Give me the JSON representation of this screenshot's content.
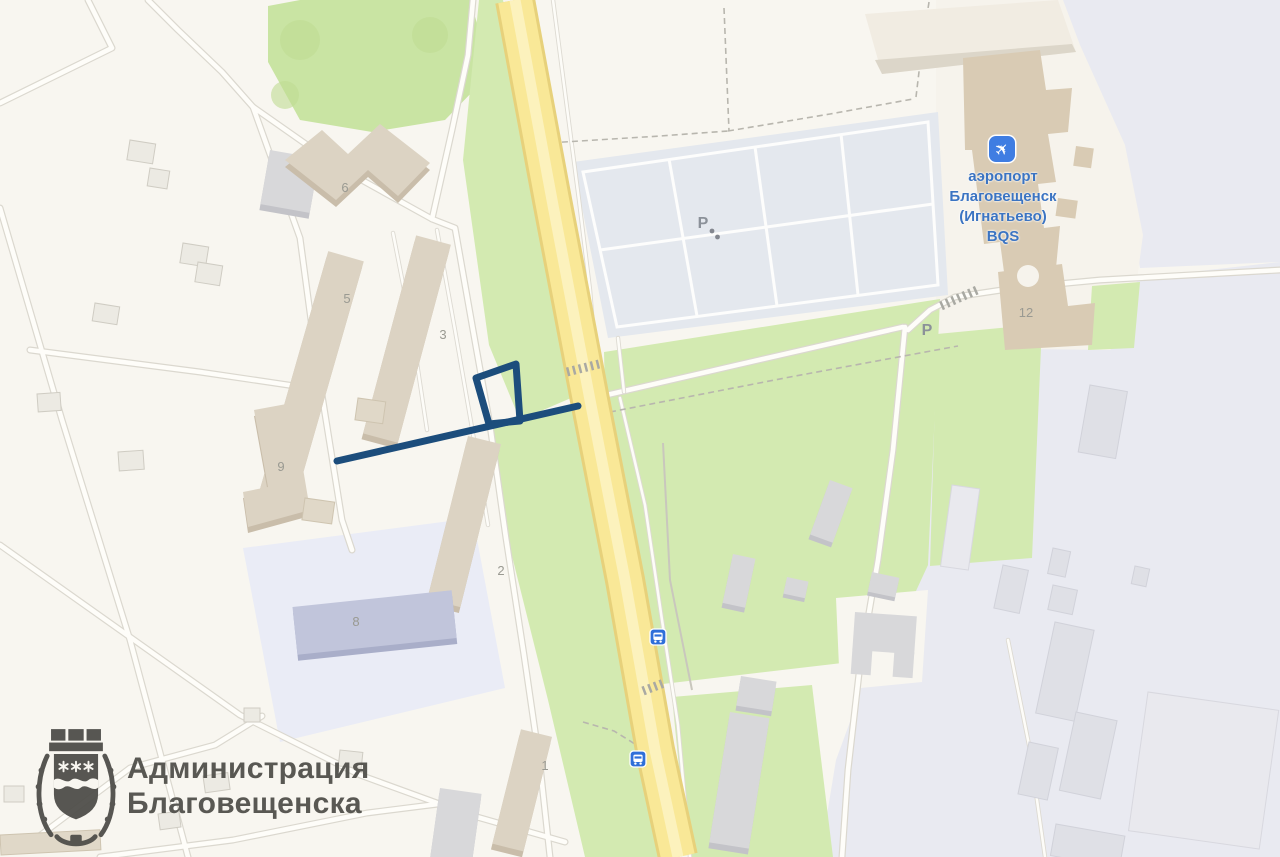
{
  "colors": {
    "base": "#f8f6f0",
    "lavender": "#e9eaf1",
    "plot-lavender": "#eaecf6",
    "green": "#d3eab1",
    "green-dark": "#c9e4a3",
    "road-yellow": "#f9e897",
    "road-yellow-edge": "#e7d17b",
    "parking": "#e4e8ee",
    "building-tan": "#dcd3c3",
    "building-gray": "#d8d8da",
    "route": "#1c4d7c",
    "icon-blue": "#3f7de2",
    "airport-blue": "#3b74c2",
    "label-gray": "#9a9a92",
    "parking-label-gray": "#8b9199",
    "watermark-gray": "#53524d"
  },
  "map": {
    "watermark": {
      "line1": "Администрация",
      "line2": "Благовещенска"
    },
    "airport": {
      "icon_glyph": "✈",
      "line1": "аэропорт",
      "line2": "Благовещенск",
      "line3": "(Игнатьево)",
      "line4": "BQS"
    },
    "building_labels": [
      "6",
      "5",
      "3",
      "9",
      "2",
      "8",
      "1",
      "12"
    ],
    "parking_labels": [
      "P",
      "P"
    ],
    "route": {
      "line_path": "M337,461 L578,406",
      "loop_path": "M476,378 L516,364 L520,421 L489,424 Z"
    }
  }
}
